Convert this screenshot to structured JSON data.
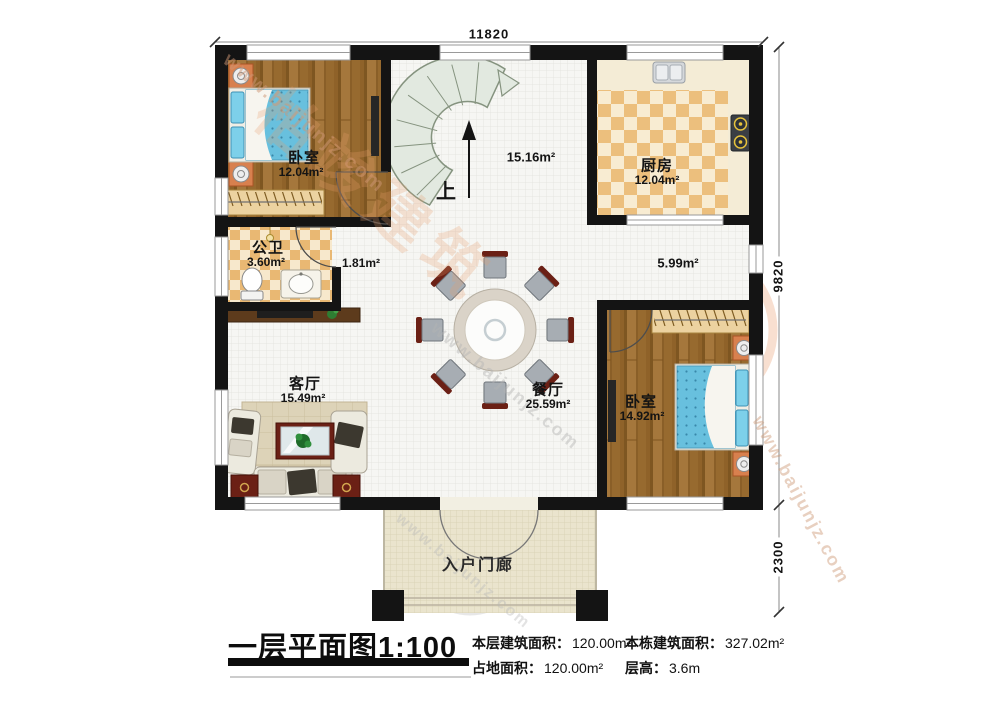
{
  "dimensions": {
    "top_width": "11820",
    "right_height_main": "9820",
    "right_height_porch": "2300"
  },
  "rooms": {
    "bedroom_left": {
      "name": "卧室",
      "area": "12.04m²"
    },
    "bathroom": {
      "name": "公卫",
      "area": "3.60m²"
    },
    "kitchen": {
      "name": "厨房",
      "area": "12.04m²"
    },
    "living_room": {
      "name": "客厅",
      "area": "15.49m²"
    },
    "dining_room": {
      "name": "餐厅",
      "area": "25.59m²"
    },
    "bedroom_right": {
      "name": "卧室",
      "area": "14.92m²"
    },
    "porch": {
      "name": "入户门廊"
    },
    "stair_hall": {
      "area": "15.16m²"
    },
    "bath_hall": {
      "area": "1.81m²"
    },
    "right_hall": {
      "area": "5.99m²"
    }
  },
  "stairs": {
    "direction_label": "上"
  },
  "title_block": {
    "title": "一层平面图1:100",
    "stats": [
      {
        "label": "本层建筑面积：",
        "value": "120.00m²"
      },
      {
        "label": "本栋建筑面积：",
        "value": "327.02m²"
      },
      {
        "label": "占地面积：",
        "value": "120.00m²"
      },
      {
        "label": "层高：",
        "value": "3.6m"
      }
    ]
  },
  "watermark": {
    "url": "www.baijunjz.com",
    "brand": "柏竣建筑",
    "logo_char": "柏"
  }
}
